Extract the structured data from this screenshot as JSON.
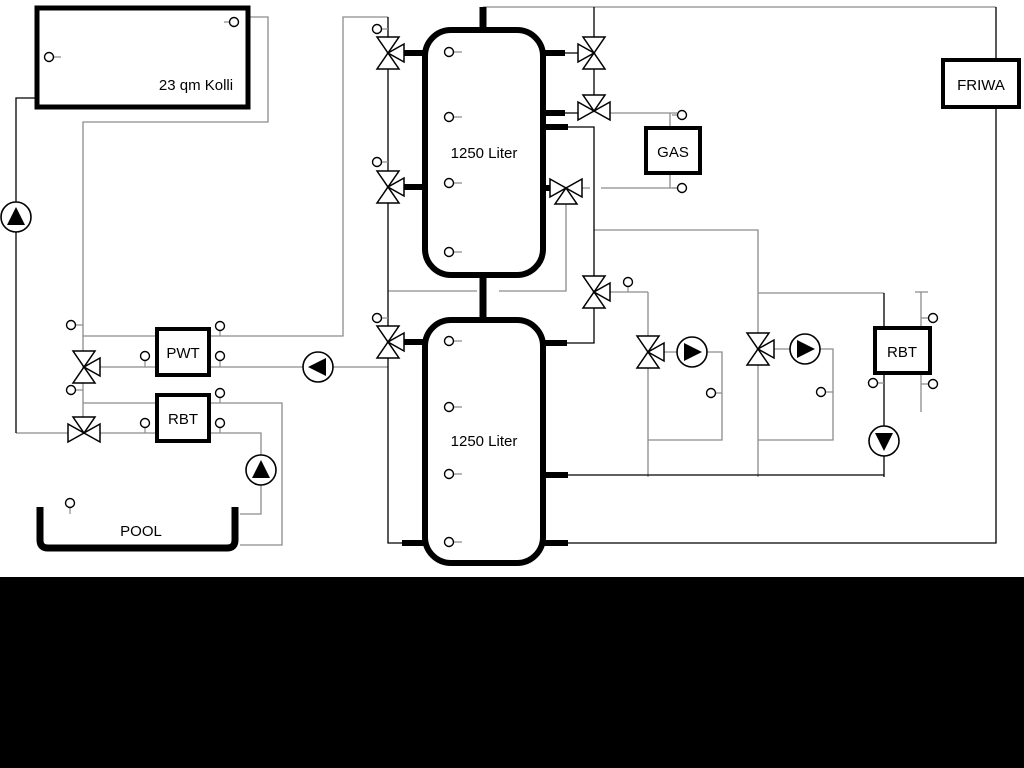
{
  "diagram": {
    "labels": {
      "collector": "23 qm Kolli",
      "tank1": "1250 Liter",
      "tank2": "1250 Liter",
      "pwt": "PWT",
      "rbt_left": "RBT",
      "gas": "GAS",
      "friwa": "FRIWA",
      "rbt_right": "RBT",
      "pool": "POOL"
    },
    "colors": {
      "background": "#ffffff",
      "pipe_gray": "#8c8c8c",
      "pipe_black": "#000000",
      "component_outline": "#000000",
      "footer_bar": "#000000"
    }
  }
}
